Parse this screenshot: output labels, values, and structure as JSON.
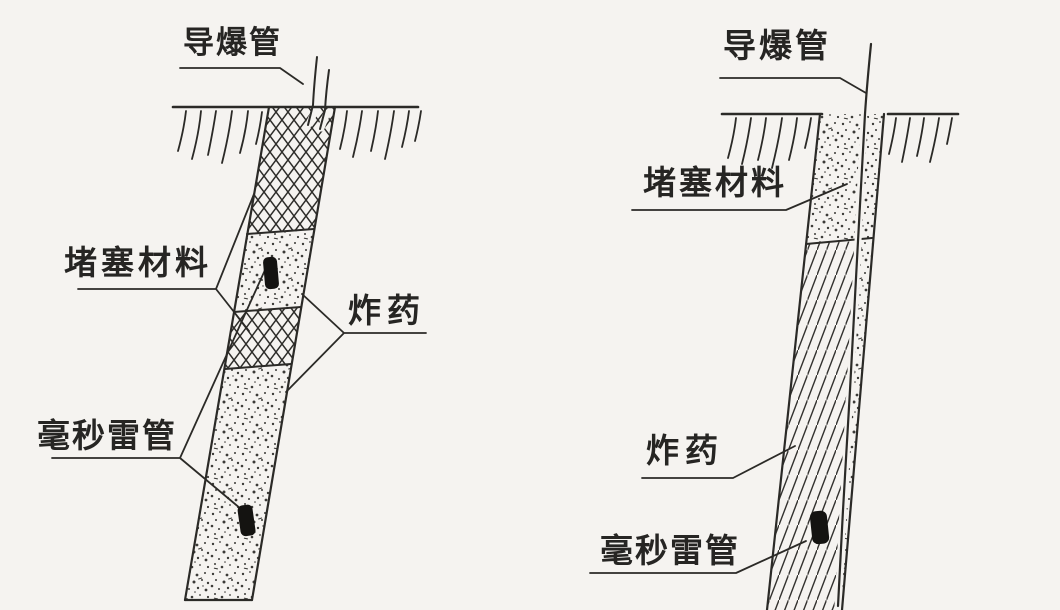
{
  "figure": {
    "background_color": "#f5f3f0",
    "ink_color": "#2b2a27",
    "left_diagram": {
      "description": "borehole-with-alternating-charge-and-stemming",
      "labels": {
        "detonating_tube": "导爆管",
        "stemming_material": "堵塞材料",
        "explosive": "炸药",
        "millisecond_detonator": "毫秒雷管"
      },
      "textures": {
        "stemming": "cross-hatch-mesh",
        "explosive": "stipple-dots"
      }
    },
    "right_diagram": {
      "description": "borehole-with-single-column-charge",
      "labels": {
        "detonating_tube": "导爆管",
        "stemming_material": "堵塞材料",
        "explosive": "炸药",
        "millisecond_detonator": "毫秒雷管"
      },
      "textures": {
        "stemming": "stipple-dots",
        "explosive": "diagonal-hatch"
      }
    }
  }
}
